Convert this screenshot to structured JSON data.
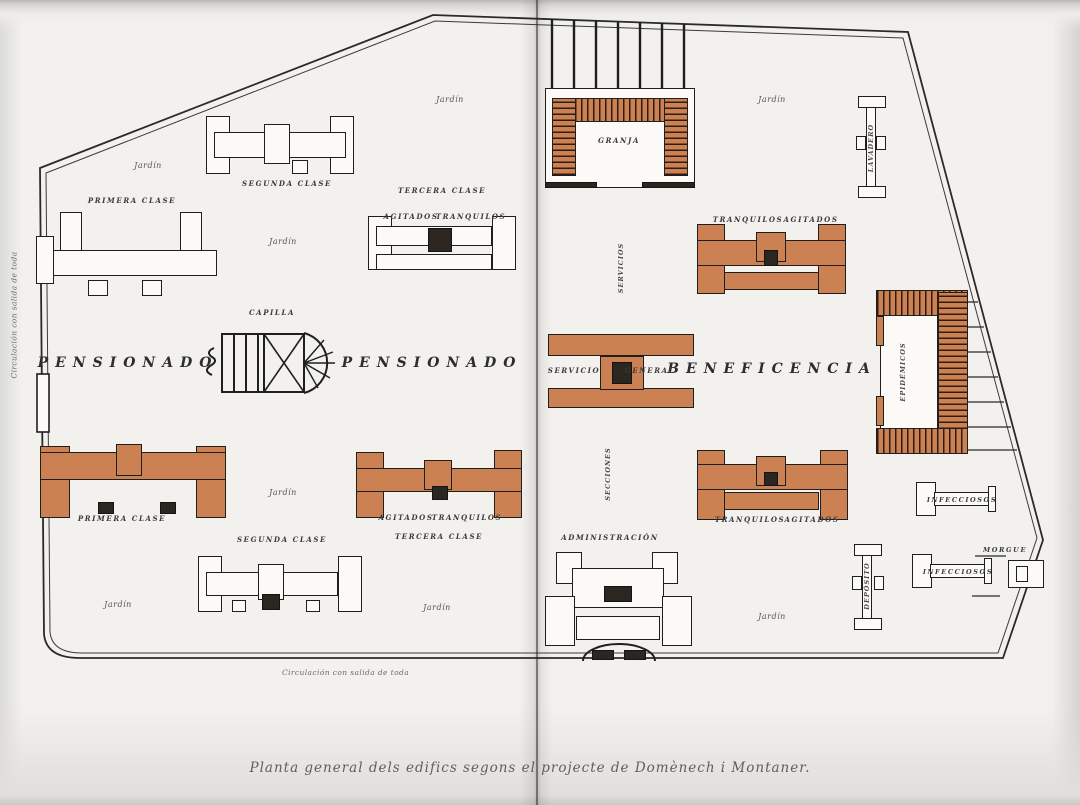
{
  "page": {
    "caption": "Planta general dels edifics segons el projecte de Domènech i Montaner."
  },
  "plan": {
    "areas": {
      "pensionado_left": "PENSIONADO",
      "pensionado_right": "PENSIONADO",
      "beneficencia": "BENEFICENCIA"
    },
    "buildings": {
      "granja": "GRANJA",
      "capilla": "CAPILLA",
      "administracion": "ADMINISTRACIÓN",
      "servicio": "SERVICIO",
      "general": "GENERAL",
      "epidemicos": "EPIDÉMICOS",
      "morgue": "MORGUE",
      "lavadero": "LAVADERO",
      "deposito": "DEPÓSITO",
      "primera_clase": "PRIMERA CLASE",
      "segunda_clase": "SEGUNDA CLASE",
      "tercera_clase": "TERCERA CLASE",
      "agitados": "AGITADOS",
      "tranquilos": "TRANQUILOS",
      "infecciosos": "INFECCIOSOS",
      "eje_servicios": "SERVICIOS",
      "eje_secciones": "SECCIONES"
    },
    "jardin_label": "Jardín",
    "notes": {
      "circulacion": "Circulación con salida de toda"
    },
    "colors": {
      "pavilion_orange": "#cc8152",
      "ink": "#222222",
      "paper": "#f2f1ee"
    }
  }
}
